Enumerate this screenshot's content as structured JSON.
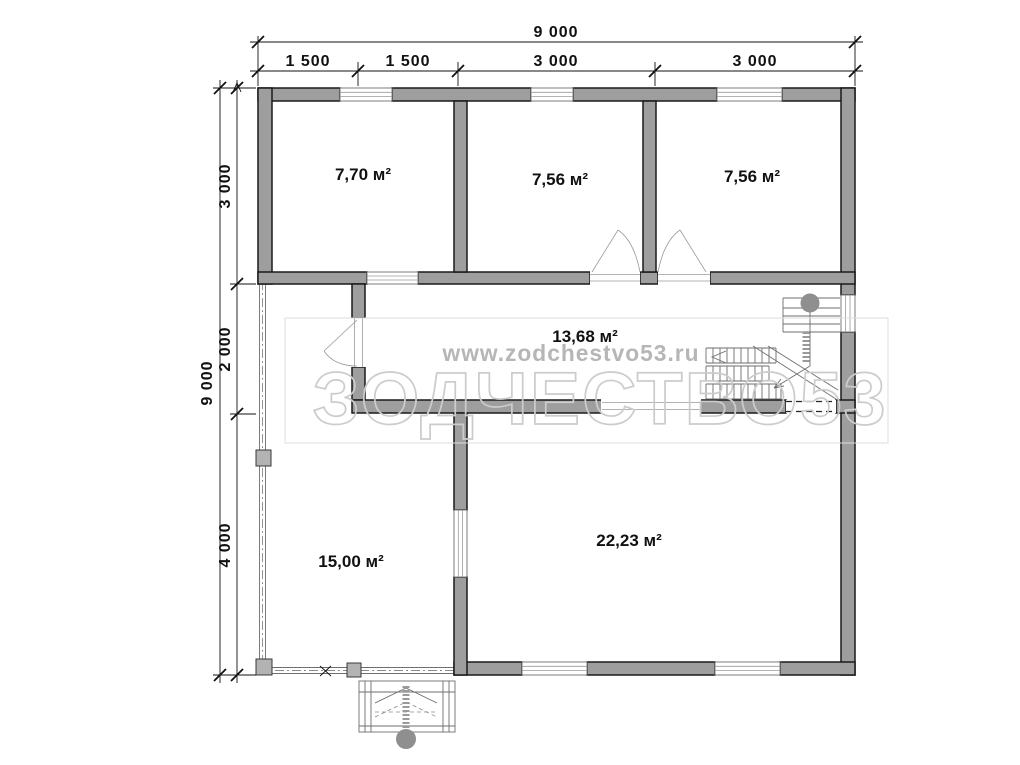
{
  "watermark": {
    "brand": "ЗОДЧЕСТВО53",
    "url": "www.zodchestvo53.ru"
  },
  "dimensions": {
    "top_total": "9 000",
    "top_segments": [
      "1 500",
      "1 500",
      "3 000",
      "3 000"
    ],
    "left_total": "9 000",
    "left_segments": [
      "3 000",
      "2 000",
      "4 000"
    ]
  },
  "rooms": {
    "top_left_area": "7,70 м²",
    "top_middle_area": "7,56 м²",
    "top_right_area": "7,56 м²",
    "hall_area": "13,68 м²",
    "living_area": "22,23 м²",
    "terrace_area": "15,00 м²"
  },
  "colors": {
    "wall_fill": "#9e9e9e",
    "outline": "#1a1a1a",
    "thin_line": "#6e6e6e",
    "dimension": "#111111",
    "watermark_outline": "#cccccc",
    "watermark_url": "#b6b6b6"
  }
}
